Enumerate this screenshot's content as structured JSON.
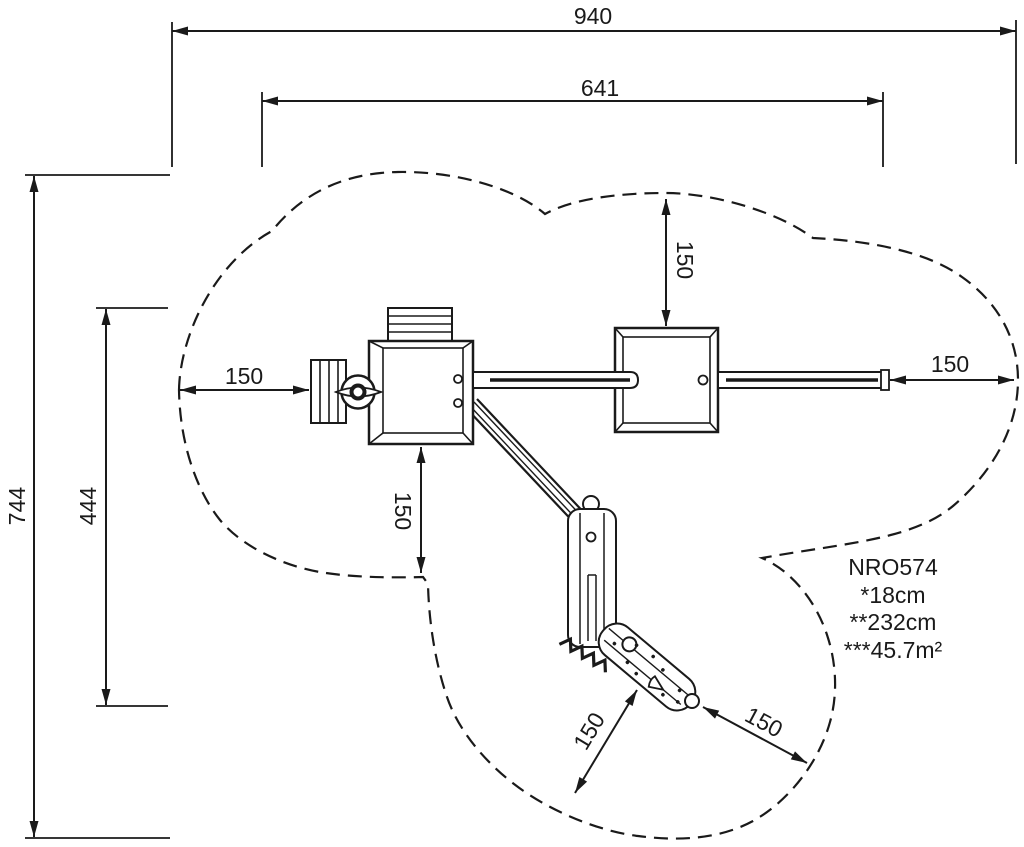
{
  "dimensions": {
    "total_width": "940",
    "inner_width": "641",
    "total_height": "744",
    "inner_height": "444",
    "clearance_left": "150",
    "clearance_right": "150",
    "clearance_top": "150",
    "clearance_bottom": "150",
    "clearance_slide_side": "150",
    "clearance_slide_end": "150"
  },
  "info_block": {
    "model": "NRO574",
    "fall_height": "*18cm",
    "equipment_height": "**232cm",
    "safety_area": "***45.7m²"
  },
  "colors": {
    "line": "#1a1a1a",
    "background": "#ffffff"
  }
}
